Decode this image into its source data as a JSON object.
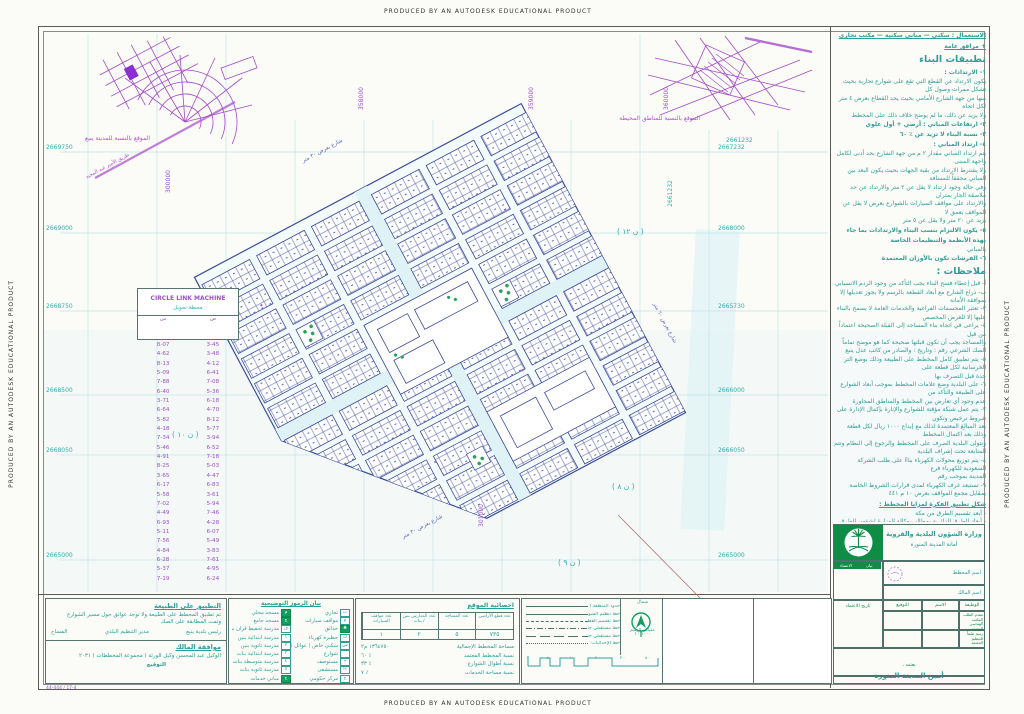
{
  "banner": {
    "text": "PRODUCED BY AN AUTODESK EDUCATIONAL PRODUCT"
  },
  "insets": {
    "city": {
      "caption": "الموقع بالنسبة للمدينة ينبع",
      "road_label": "طريق الأمير عبد المجيد"
    },
    "surrounding": {
      "caption": "الموقع بالنسبة للمناطق المحيطة",
      "coord": "2661232"
    }
  },
  "map": {
    "grid_rows": [
      {
        "y": 152,
        "left": "2669750",
        "right": "2667232"
      },
      {
        "y": 233,
        "left": "2669000",
        "right": "2668000"
      },
      {
        "y": 311,
        "left": "2668750",
        "right": "2665730"
      },
      {
        "y": 395,
        "left": "2668500",
        "right": "2666000"
      },
      {
        "y": 455,
        "left": "2668050",
        "right": "2666050"
      },
      {
        "y": 560,
        "left": "2665000",
        "right": "2665000"
      }
    ],
    "rot_labels": [
      {
        "x": 350,
        "y": 95,
        "t": "358000",
        "c": "p"
      },
      {
        "x": 520,
        "y": 95,
        "t": "359000",
        "c": "p"
      },
      {
        "x": 655,
        "y": 95,
        "t": "360000",
        "c": "p"
      },
      {
        "x": 157,
        "y": 178,
        "t": "300000",
        "c": "p"
      },
      {
        "x": 470,
        "y": 512,
        "t": "301000",
        "c": "p"
      },
      {
        "x": 657,
        "y": 190,
        "t": "2661232",
        "c": ""
      }
    ],
    "district_labels": [
      {
        "x": 617,
        "y": 227,
        "t": "( ن ١٢ )"
      },
      {
        "x": 172,
        "y": 430,
        "t": "( ن ١٠ )"
      },
      {
        "x": 612,
        "y": 482,
        "t": "( ن ٨ )"
      },
      {
        "x": 558,
        "y": 558,
        "t": "( ن ٩ )"
      }
    ],
    "street_labels": [
      {
        "x": 300,
        "y": 148,
        "r": -28,
        "t": "شارع بعرض ٣٠ متر"
      },
      {
        "x": 400,
        "y": 524,
        "r": -28,
        "t": "شارع بعرض ٣٠ متر"
      },
      {
        "x": 642,
        "y": 320,
        "r": 62,
        "t": "شارع بعرض ٦٠ متر"
      }
    ]
  },
  "coord_table": {
    "title": "CIRCLE LINK MACHINE",
    "subtitle": "محطة تحويل",
    "col_a": "س",
    "col_b": "ص",
    "rows": [
      [
        "8-07",
        "3-45"
      ],
      [
        "4-62",
        "3-48"
      ],
      [
        "8-13",
        "4-12"
      ],
      [
        "5-09",
        "6-41"
      ],
      [
        "7-88",
        "7-08"
      ],
      [
        "6-40",
        "5-36"
      ],
      [
        "3-71",
        "6-18"
      ],
      [
        "6-64",
        "4-70"
      ],
      [
        "5-82",
        "8-12"
      ],
      [
        "4-18",
        "5-77"
      ],
      [
        "7-34",
        "3-94"
      ],
      [
        "5-46",
        "6-52"
      ],
      [
        "4-91",
        "7-18"
      ],
      [
        "8-25",
        "5-03"
      ],
      [
        "3-65",
        "4-47"
      ],
      [
        "6-17",
        "6-83"
      ],
      [
        "5-58",
        "3-61"
      ],
      [
        "7-02",
        "5-94"
      ],
      [
        "4-49",
        "7-46"
      ],
      [
        "6-93",
        "4-28"
      ],
      [
        "5-11",
        "6-07"
      ],
      [
        "7-56",
        "5-49"
      ],
      [
        "4-84",
        "3-83"
      ],
      [
        "6-28",
        "7-61"
      ],
      [
        "5-37",
        "4-95"
      ],
      [
        "7-19",
        "6-24"
      ]
    ]
  },
  "bottom": {
    "field_check": {
      "title": "التطبيق على الطبيعة",
      "line1": "تم تطبيق المخطط على الطبيعة ولا توجد عوائق حول مسير الشوارع",
      "line2": "وتمت المطابقة على الصك",
      "sig1": "المساح",
      "sig2": "مدير التنظيم البلدي",
      "sig3": "رئيس بلدية ينبع",
      "owner_title": "موافقة المالك",
      "owner_line": "الوكيل عبد المحسن وكيل الورثة ( مجموعة المخططات ) ٢٠٣١",
      "sign_label": "التوقيع",
      "footnote": "44-444 / 17-4"
    },
    "legend": {
      "title": "بيان الرموز التوضيحية",
      "right_rows": [
        {
          "label": "تجاري",
          "sym": "ت",
          "g": false
        },
        {
          "label": "مواقف سيارات",
          "sym": "م",
          "g": false
        },
        {
          "label": "حدائق",
          "sym": "♣",
          "g": true
        },
        {
          "label": "حظيرة كهرباء",
          "sym": "ك",
          "g": false
        },
        {
          "label": "سكني خاص ( عوائل )",
          "sym": "س",
          "g": false
        },
        {
          "label": "شوارع",
          "sym": "",
          "g": false
        },
        {
          "label": "مستوصف",
          "sym": "+",
          "g": false
        },
        {
          "label": "مستشفى",
          "sym": "H",
          "g": false
        },
        {
          "label": "مركز حكومي",
          "sym": "ح",
          "g": false
        }
      ],
      "left_rows": [
        {
          "label": "مسجد محلي",
          "sym": "م",
          "g": true
        },
        {
          "label": "مسجد جامع",
          "sym": "ج",
          "g": true
        },
        {
          "label": "مدرسة تحفيظ قرآن بنين",
          "sym": "ق",
          "g": false
        },
        {
          "label": "مدرسة ابتدائية بنين",
          "sym": "١",
          "g": false
        },
        {
          "label": "مدرسة ثانوية بنين",
          "sym": "٢",
          "g": false
        },
        {
          "label": "مدرسة ابتدائية بنات",
          "sym": "٣",
          "g": false
        },
        {
          "label": "مدرسة متوسطة بنات",
          "sym": "٤",
          "g": false
        },
        {
          "label": "مدرسة ثانوية بنات",
          "sym": "٥",
          "g": false
        },
        {
          "label": "مباني خدمات",
          "sym": "خ",
          "g": true
        }
      ]
    },
    "stats": {
      "title": "احصائية الموقع",
      "cols": [
        "عدد قطع الأراضي",
        "عدد المساجد",
        "عدد المدارس بنين / بنات",
        "عدد مواقف السيارات"
      ],
      "values": [
        "٧٣٥",
        "٥",
        "٢",
        "١"
      ],
      "lines": [
        {
          "label": "مساحة المخطط الإجمالية",
          "value": "١٣٦٤٧٥٠ م٢"
        },
        {
          "label": "نسبة المخطط المعتمد",
          "value": "٪ ٦٠"
        },
        {
          "label": "نسبة أطوال الشوارع",
          "value": "٪ ٣٣"
        },
        {
          "label": "نسبة مساحة الخدمات",
          "value": "٪ ٧"
        }
      ]
    },
    "linetypes": {
      "rows": [
        {
          "label": "حدود المنطقة ( حسب الصك )",
          "s": "s1"
        },
        {
          "label": "خط تنظيم الشوارع والمرافق",
          "s": "s2"
        },
        {
          "label": "خط تقسيم القطع السكنية المعتمدة",
          "s": "s3"
        },
        {
          "label": "خط مستقبلي خارج تنظيم الشوارع",
          "s": "s4"
        },
        {
          "label": "خط مستقبلي خارج تنظيم القطع السكنية",
          "s": "s6"
        },
        {
          "label": "خط الإحداثيات",
          "s": "s5"
        }
      ],
      "scale_ticks": [
        "٠",
        "٥٠",
        "١٠٠",
        "٢٠٠",
        "٣٠٠",
        "٥٠٠"
      ]
    },
    "north": {
      "top": "شمال",
      "label": "مقياس الرسم",
      "scale": "١٠٠٠ : ١"
    }
  },
  "titleblock": {
    "ministry_line1": "وزارة الشؤون البلدية والقروية",
    "ministry_line2": "أمانة المدينة المنورة",
    "left_header_a": "بيان",
    "left_header_b": "الاعتماد",
    "left_rows": [
      {
        "label": "الحي",
        "value": "حمراء"
      },
      {
        "label": "المدينة",
        "value": "ينبع"
      },
      {
        "label": "المنطقة",
        "value": "المدينة المنورة"
      },
      {
        "label": "رقم الاعتماد",
        "value": "٧٠٩ م"
      }
    ],
    "date_label": "تاريخ الاعتماد",
    "plan_name_label": "اسم المخطط",
    "owner_label": "اسم المالك",
    "job": "الوظيفة",
    "name": "الاسم",
    "sig": "التوقيع",
    "row_label_1": "مقدم الطلب المكتب الهندسي المعتمد",
    "row_label_2": "رسم طبقاً للتنظيم المعتمد",
    "approve_small": "يعتمد ،",
    "mayor": "أمين المدينة المنورة"
  },
  "notes": {
    "lines": [
      {
        "c": "u",
        "t": "الاستعمال :  سكني — مباني سكنية — مكتب تجاري + مرافق عامة"
      },
      {
        "c": "h2",
        "t": "تطبيقات البناء"
      },
      {
        "c": "it",
        "t": "١- الارتدادات :"
      },
      {
        "c": "p",
        "t": "يكون الارتداد عن القطع التي تقع على شوارع تجارية بحيث تشكل ممرات وصول كل"
      },
      {
        "c": "p",
        "t": "منها من جهة الشارع الأمامي بحيث يحد القطاع بعرض ٤ متر لكل اتجاه"
      },
      {
        "c": "p",
        "t": "ولا يزيد عن ذلك، ما لم يوضح خلاف ذلك على المخطط"
      },
      {
        "c": "it",
        "t": "٢- ارتفاعات المباني : أرضي + أول علوي"
      },
      {
        "c": "it",
        "t": "٣- نسبة البناء لا تزيد عن ٪ ٦٠"
      },
      {
        "c": "it",
        "t": "٤- ارتداد المباني :"
      },
      {
        "c": "p",
        "t": "يتم ارتداد المباني مقدار ٢ م من جهة الشارع بحد أدنى لكامل واجهة المبنى"
      },
      {
        "c": "p",
        "t": "ولا يشترط الارتداد من بقية الجهات بحيث يكون البعد بين المباني محققاً للمسافة"
      },
      {
        "c": "p",
        "t": "وفي حالة وجود ارتداد لا يقل عن ٢ متر والارتداد عن حد ملاصقة الجار بمتران"
      },
      {
        "c": "p",
        "t": "والارتداد على مواقف السيارات بالشوارع بعرض لا يقل عن المواقف بعمق لا"
      },
      {
        "c": "p",
        "t": "يزيد عن ٢٠ متر ولا يقل عن ٥ متر"
      },
      {
        "c": "it",
        "t": "٥- يكون الالتزام بنسب البناء والارتدادات بما جاء بهذه الأنظمة والتنظيمات الخاصة"
      },
      {
        "c": "p",
        "t": "بالمباني"
      },
      {
        "c": "it",
        "t": "٦- الفرشات تكون بالأوزان المعتمدة"
      },
      {
        "c": "h2",
        "t": "ملاحظات :"
      },
      {
        "c": "p",
        "t": "أ- قبل إعطاء فسح البناء يجب التأكد من وجود الردم الانسيابي"
      },
      {
        "c": "p",
        "t": "ب- ذراع الشارع مع أبعاد القطعة بالرسم ولا يجوز تعديلها إلا بموافقة الأمانة"
      },
      {
        "c": "p",
        "t": "٣- تعتبر المجسمات الفراغية والخدمات العامة لا يسمح بالبناء عليها إلا للغرض المخصص"
      },
      {
        "c": "p",
        "t": "٤- يراعى في اتجاه بناء المساجد إلى القبلة الصحيحة اعتماداً من قبل"
      },
      {
        "c": "p",
        "t": "والمساجد يجب أن تكون قبلتها صحيحة كما هو موضح تماماً"
      },
      {
        "c": "p",
        "t": "الصك الشرعي رقم :      وتاريخ :      والصادر من كاتب عدل ينبع"
      },
      {
        "c": "p",
        "t": "٥- يتم تطبيق كامل المخطط على الطبيعة وذلك بوضع التر الخرسانية لكل قطعة على"
      },
      {
        "c": "p",
        "t": "حدة قبل التصرف بها"
      },
      {
        "c": "p",
        "t": "٦- على البلدية وضع علامات المخطط بموجب أبعاد الشوارع على الطبيعة والتأكد من"
      },
      {
        "c": "p",
        "t": "عدم وجود أي تعارض بين المخطط والمناطق المجاورة"
      },
      {
        "c": "p",
        "t": "٧- يتم عمل شبكة مؤقتة للشوارع والإنارة بإكمال الإدارة على شروط ترخيص وتكون"
      },
      {
        "c": "p",
        "t": "بعد المبالغ المعتمدة لذلك مع إيداع ١٠٠٠ ريال لكل قطعة وذلك بعد اكتمال المخطط"
      },
      {
        "c": "p",
        "t": "وتتولى البلدية الصرف على المخطط والرجوع إلى النظام وتتم المتابعة تحت إشراف البلدية"
      },
      {
        "c": "p",
        "t": "٨- يتم توزيع محولات الكهرباء بناءً على طلب الشركة السعودية للكهرباء فرع"
      },
      {
        "c": "p",
        "t": "المدينة بموجب رقم"
      },
      {
        "c": "p",
        "t": "٩- تستبعد غرف الكهرباء لمدى قرارات الشروط الخاصة بمقابل مجمع المواقف بعرض ١٠ م ٤٤١"
      },
      {
        "c": "u",
        "t": "شكل تطبيق الفكرة لمزايا المخطط :"
      },
      {
        "c": "p",
        "t": "- أبعد تقسيم الطرق من مكة"
      },
      {
        "c": "p",
        "t": "- أبعاد الطرق الدائرية بمطالب وكالة الوزارة لشؤون الطرق"
      },
      {
        "c": "p",
        "t": "- وضع القرية التصميمي : لا يتجاوز الارتفاع"
      },
      {
        "c": "p",
        "t": "- عمق المناسيب : ٢٠ متر من منسوب سطح الأرض الطبيعية"
      },
      {
        "c": "p",
        "t": "- نوع المناسيب : القطرات المنفصلة من المرحلة المنفصلة"
      },
      {
        "c": "p",
        "t": "- المحيط الكلي للمشروع : ٦٠ م"
      },
      {
        "c": "p",
        "t": "- المحيط العقاري المسموح به : ٣٥٤ م"
      },
      {
        "c": "p",
        "t": "- كثافة القطع : ٨٥٠ م٢"
      },
      {
        "c": "p",
        "t": "- شفط منسوب المياه السطحية : تحدد عند الواقع في العوائق الواقعة من مدخل في"
      },
      {
        "c": "p",
        "t": "غير مرئي على الوحدات وقد تظهر في بعض الجهات"
      },
      {
        "c": "p",
        "t": "- الفرسبات الخاصة تعتمد على الفوارق"
      },
      {
        "c": "p",
        "t": "أ- يوجد ضمن رفع الحفر لأي عمق على مدى الشك من قطر من أنه مواد ردمية وفي"
      },
      {
        "c": "p",
        "t": "حالة وجودها يجب حفر العلم للوصول إلى الأرض سليمة مع ذلك ردم الحفر"
      },
      {
        "c": "p",
        "t": "بكافة التربة مع التهوية باستمرار عمودية خارجية بطبقة سطح مكبرة ويجب"
      },
      {
        "c": "p",
        "t": "أن تكون الأرض مستوية تحت الأساسيات"
      },
      {
        "c": "p",
        "t": "ب- يجب استخدام الأسمنت المقاوم للأملاح والكبريتات في جميع أعمال الأساسات"
      },
      {
        "c": "p",
        "t": "والخرسانات تحت الأرضية"
      }
    ]
  }
}
